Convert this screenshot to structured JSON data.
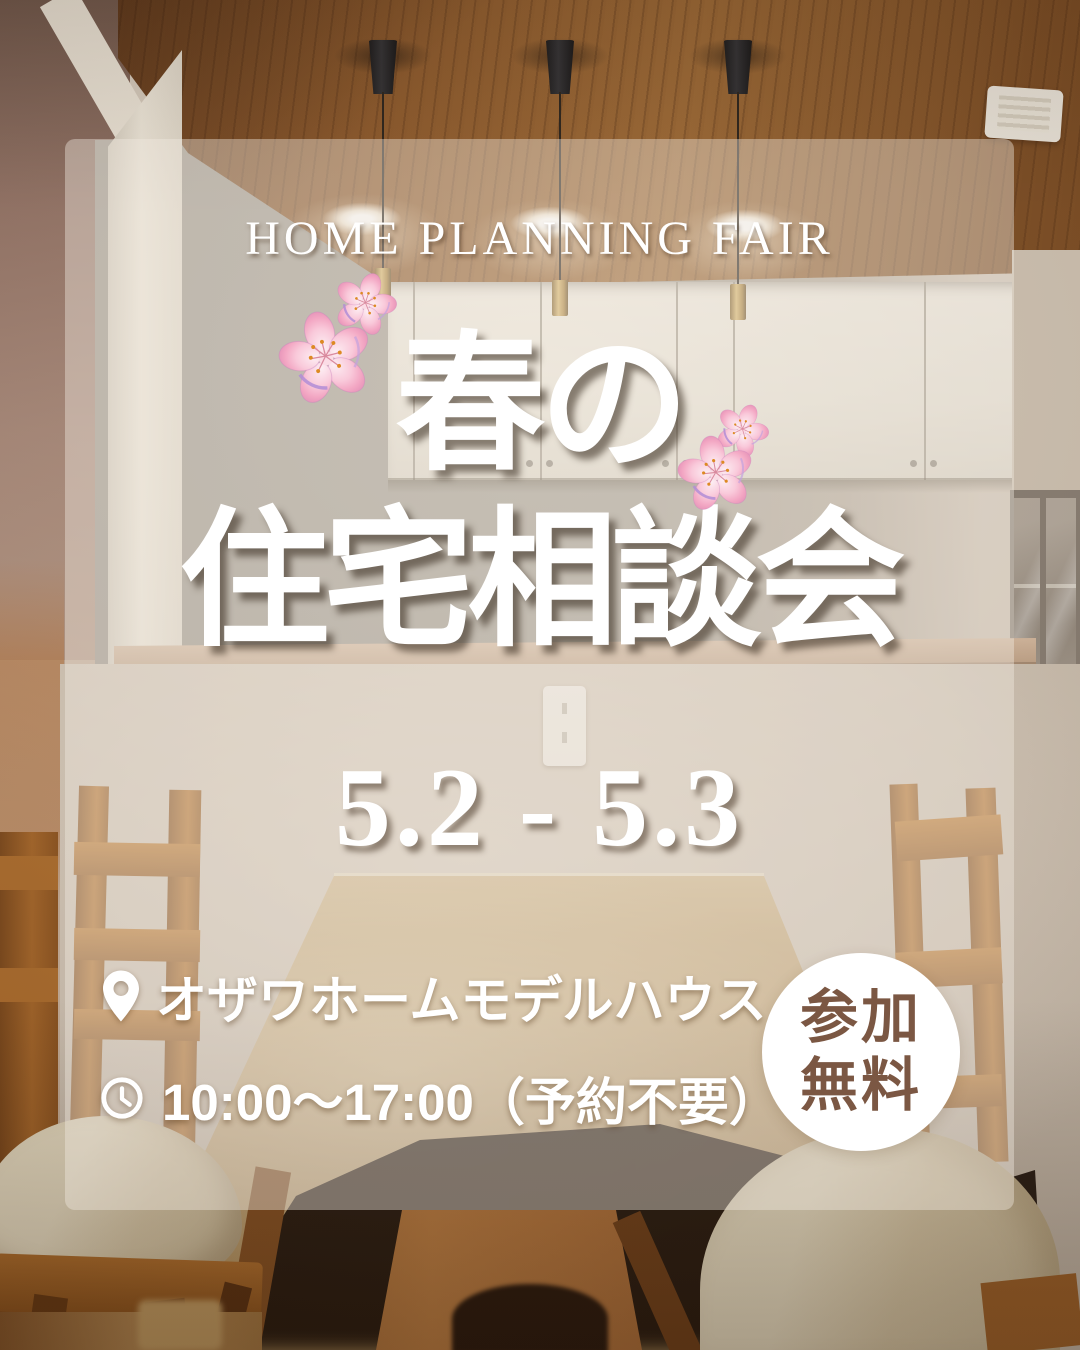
{
  "event": {
    "eyebrow": "HOME PLANNING FAIR",
    "title_line1": "春の",
    "title_line2": "住宅相談会",
    "dates": "5.2 - 5.3",
    "location": "オザワホームモデルハウス",
    "hours": "10:00〜17:00（予約不要）",
    "badge": {
      "line1": "参加",
      "line2": "無料"
    }
  },
  "icons": {
    "location": "map-pin-icon",
    "hours": "clock-icon",
    "decoration": "cherry-blossom-icon"
  },
  "colors": {
    "headline_text": "#ffffff",
    "badge_text": "#7b5743",
    "badge_background": "#ffffff",
    "overlay_panel": "rgba(240,234,223,0.42)",
    "blossom_pink": "#f5b5cc",
    "ceiling_wood": "#8a5527",
    "table_wood": "#c9aa78",
    "chair_wood": "#b5722e"
  },
  "scene": "dining-kitchen-interior-photo"
}
